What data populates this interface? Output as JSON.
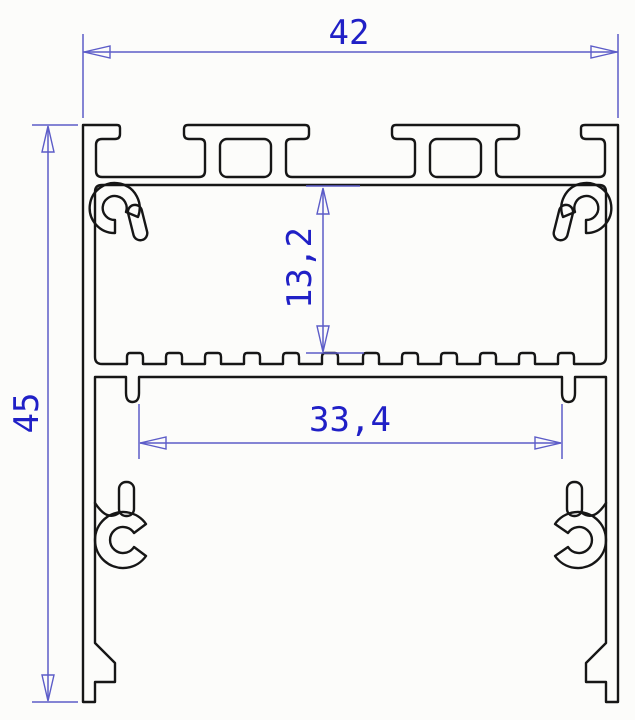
{
  "drawing": {
    "title": "aluminium-led-profile-cross-section",
    "dimensions": {
      "overall_width_mm": "42",
      "overall_height_mm": "45",
      "channel_depth_mm": "13,2",
      "inner_width_mm": "33,4"
    },
    "colors": {
      "outline": "#161616",
      "dimension_line": "#5c5cc8",
      "dimension_text": "#2020c6",
      "background": "#fcfcfa"
    }
  }
}
